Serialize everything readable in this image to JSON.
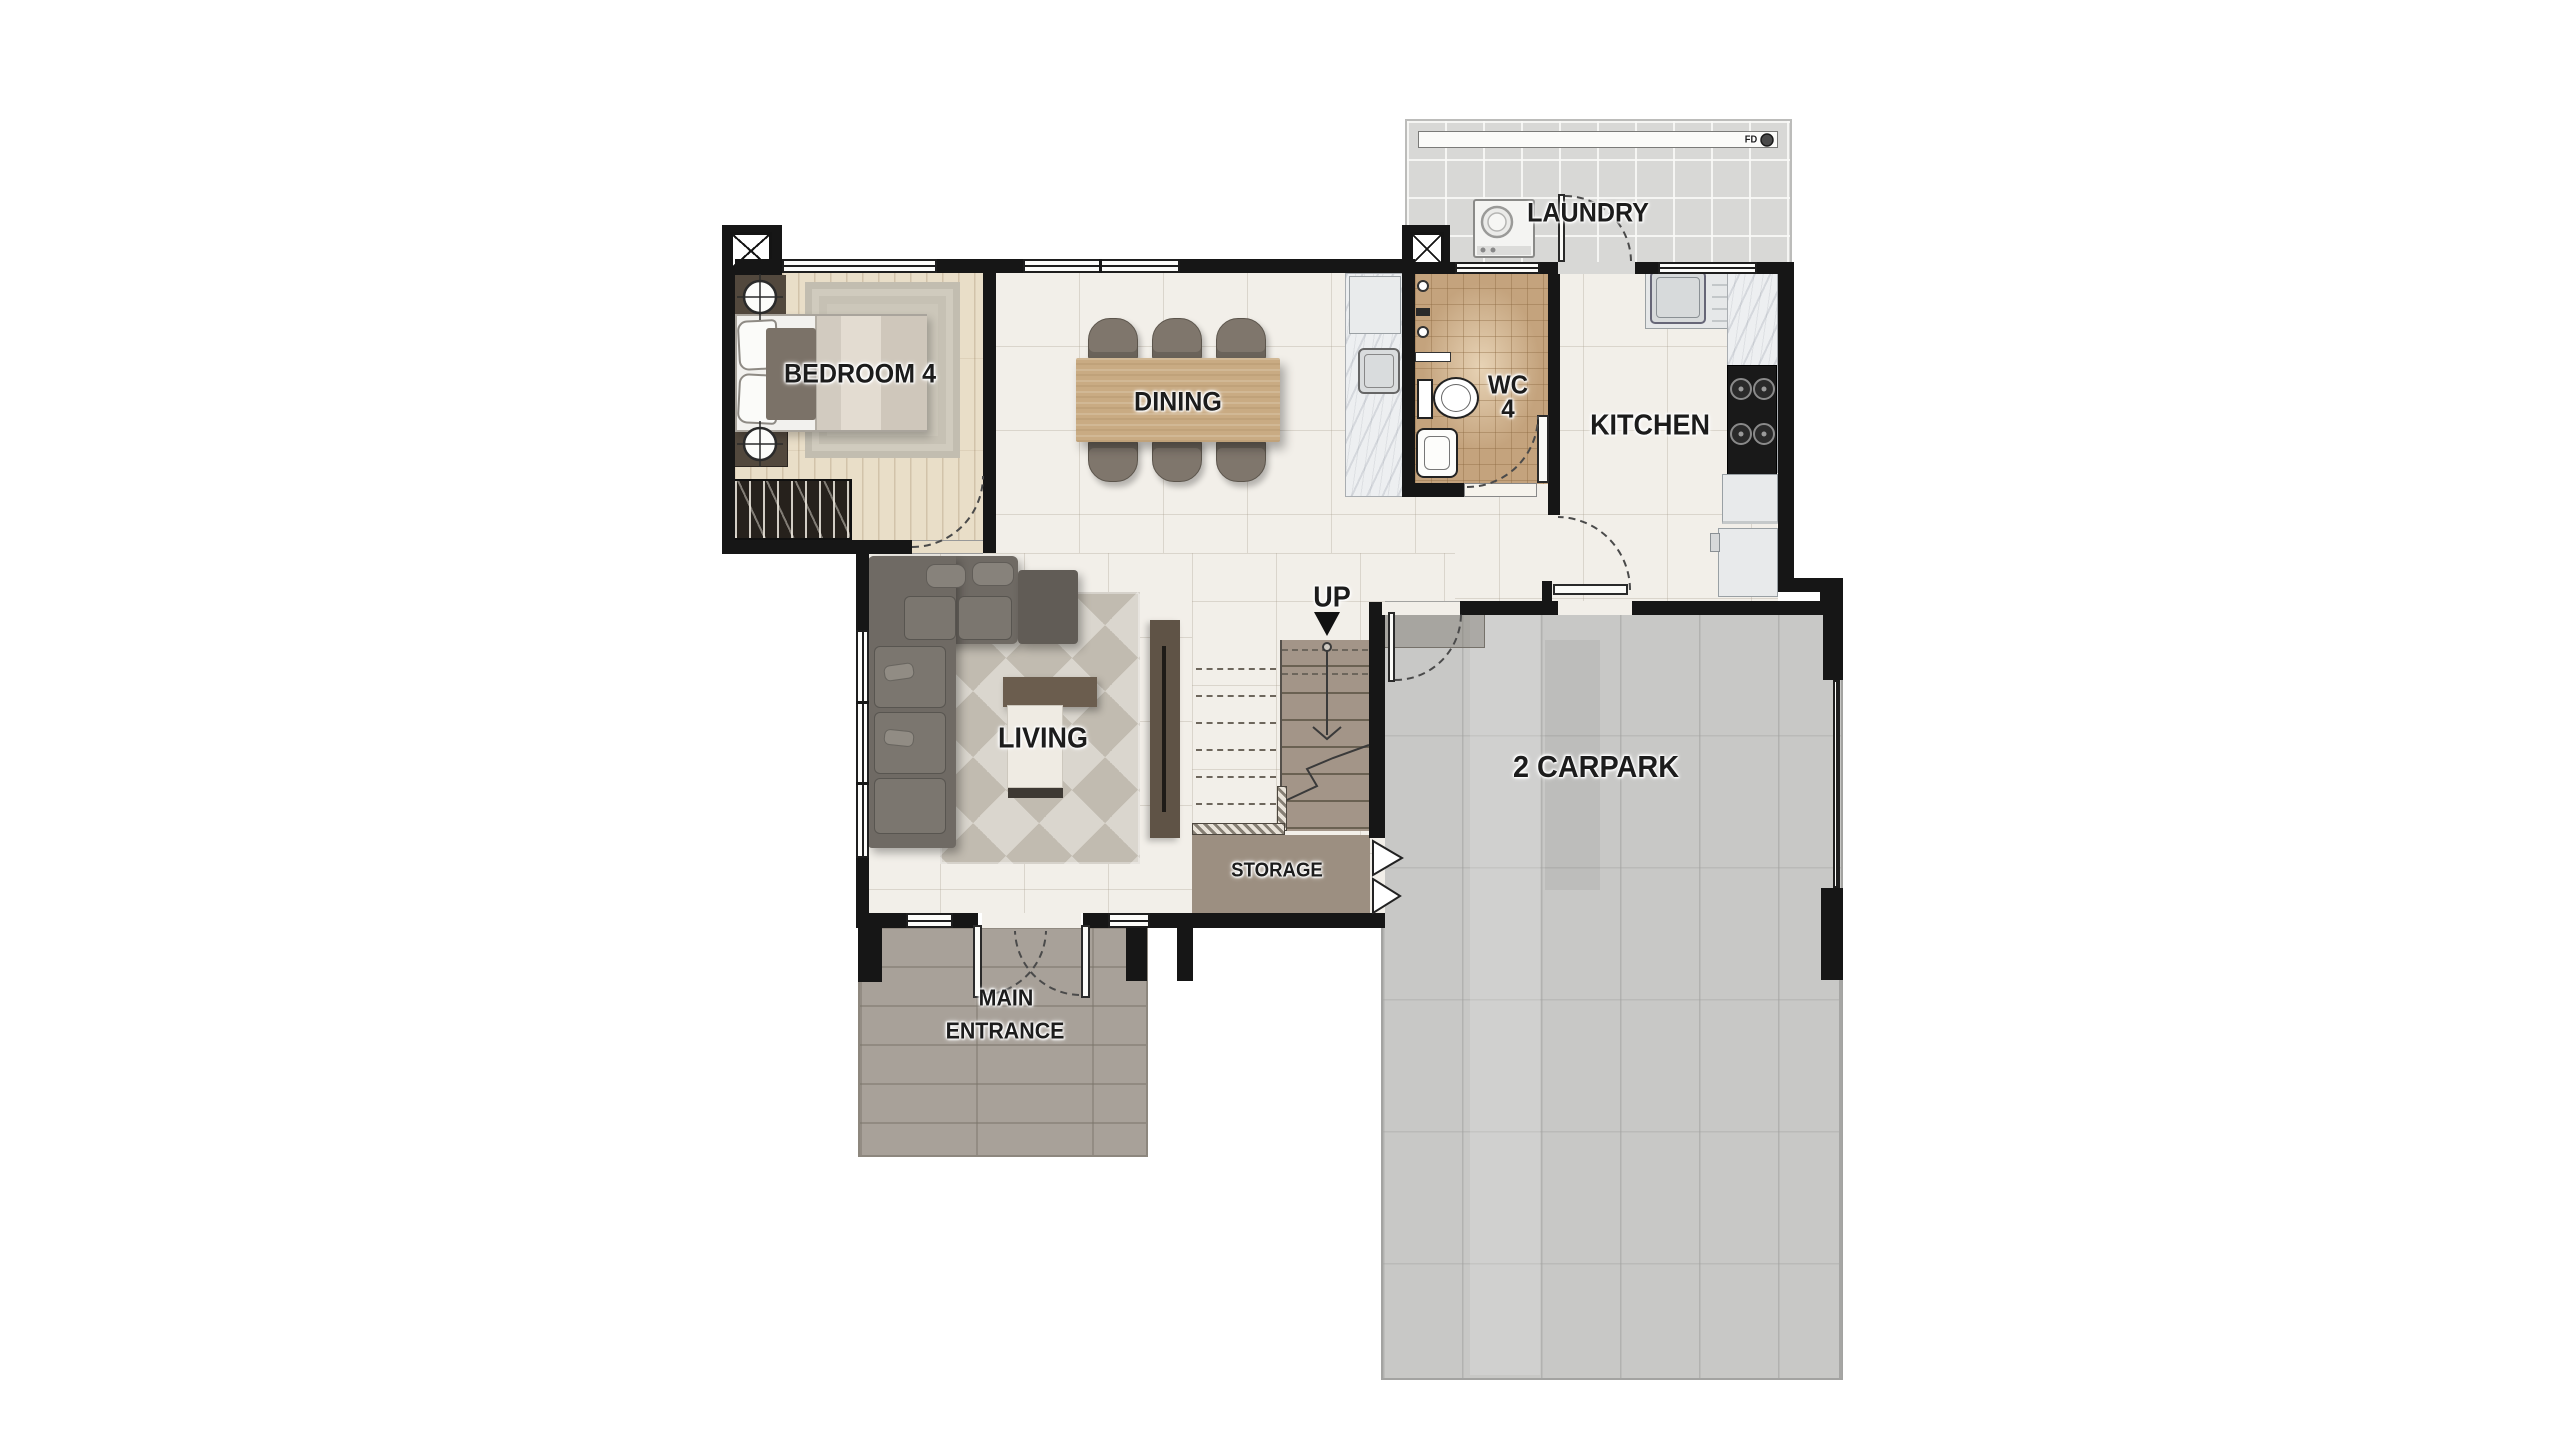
{
  "rooms": {
    "bedroom4": {
      "label": "BEDROOM 4"
    },
    "dining": {
      "label": "DINING"
    },
    "wc4": {
      "line1": "WC",
      "line2": "4"
    },
    "kitchen": {
      "label": "KITCHEN"
    },
    "laundry": {
      "label": "LAUNDRY"
    },
    "living": {
      "label": "LIVING"
    },
    "storage": {
      "label": "STORAGE"
    },
    "main_entrance": {
      "line1": "MAIN",
      "line2": "ENTRANCE"
    },
    "carpark": {
      "label": "2 CARPARK"
    }
  },
  "annotations": {
    "stairs_direction": "UP",
    "floor_drain": "FD"
  },
  "colors": {
    "wall": "#161616",
    "interior_tile": "#f2efe9",
    "bedroom_wood": "#e9dec8",
    "wc_tile": "#c4a37d",
    "laundry_tile": "#d8d8d6",
    "porch": "#a8a199",
    "carpark_concrete": "#c8c8c6",
    "stair_tread": "#a39588",
    "storage_floor": "#9c8f81",
    "dining_table": "#c9ab83",
    "sofa": "#6f6a64",
    "label_text": "#1c1c1c"
  }
}
